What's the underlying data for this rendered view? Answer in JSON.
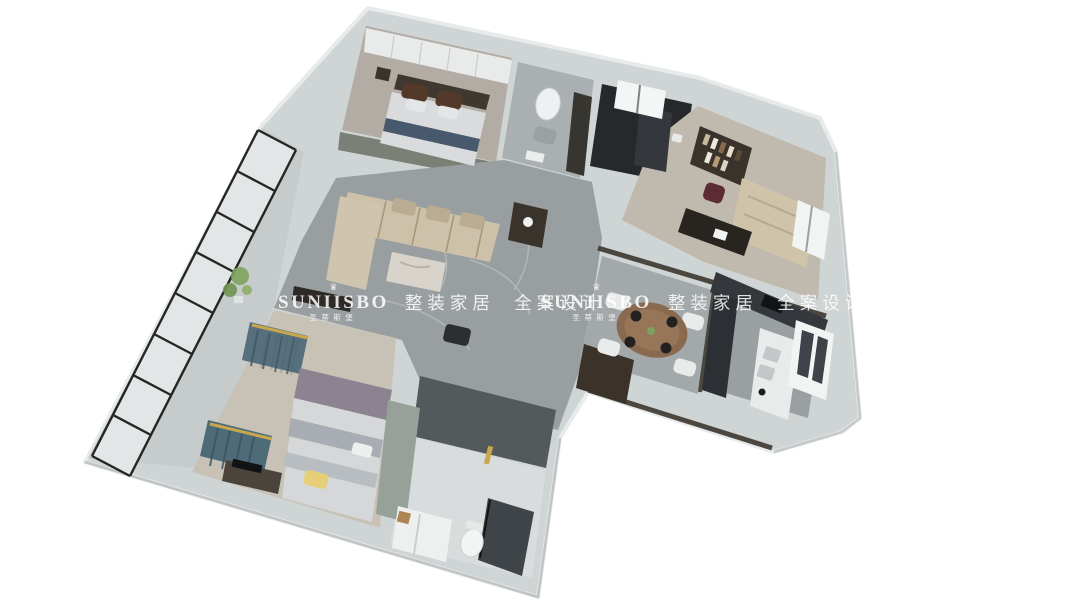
{
  "watermarks": [
    {
      "crown_glyph": "♛",
      "brand": "SUNIISBO",
      "brand_sub": "圣蒂斯堡",
      "tagline": "整装家居 全案设计"
    },
    {
      "crown_glyph": "♛",
      "brand": "SUNIISBO",
      "brand_sub": "圣蒂斯堡",
      "tagline": "整装家居 全案设计"
    }
  ],
  "colors": {
    "background": "#ffffff",
    "outer_wall": "#d0d4d5",
    "floor_marble": "#989d9f",
    "dark_bath_tile": "#26282c",
    "sofa_beige": "#cdc2a9",
    "bed_runner_blue": "#49596d",
    "curtain_teal": "#547384",
    "accent_gold": "#c9a84c",
    "dining_wood": "#8a6a4e",
    "glass_frame_black": "#161616",
    "plant_green": "#7da35c",
    "watermark_white": "rgba(255,255,255,0.85)"
  }
}
